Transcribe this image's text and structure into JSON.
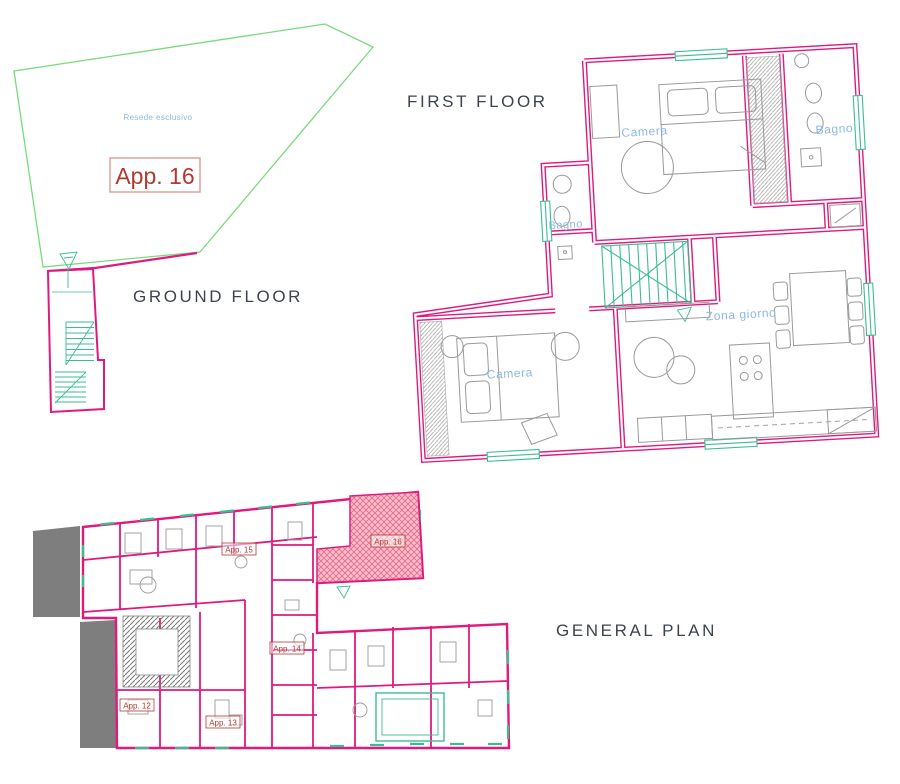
{
  "sections": {
    "ground_floor": {
      "title": "GROUND FLOOR",
      "garden_label": "Resede esclusivo",
      "apartment_box_label": "App. 16"
    },
    "first_floor": {
      "title": "FIRST FLOOR",
      "rooms": {
        "bedroom_upper": "Camera",
        "bathroom_right": "Bagno",
        "bathroom_left": "Bagno",
        "bedroom_lower": "Camera",
        "living_area": "Zona giorno"
      }
    },
    "general_plan": {
      "title": "GENERAL PLAN",
      "highlight_label": "App. 16",
      "apartments": [
        {
          "label": "App. 15"
        },
        {
          "label": "App. 14"
        },
        {
          "label": "App. 12"
        },
        {
          "label": "App. 13"
        }
      ]
    }
  },
  "colors": {
    "wall_pink": "#e01a7d",
    "window_teal": "#3bbd94",
    "garden_green": "#79da7c",
    "label_blue": "#8db7e3",
    "label_red": "#b13a30",
    "title_gray": "#3d4450",
    "area_gray": "#7e7e7e",
    "furniture_gray": "#9a9a9a",
    "highlight_pink_bg": "#f7c0cb",
    "highlight_pink_line": "#e96a8b"
  }
}
